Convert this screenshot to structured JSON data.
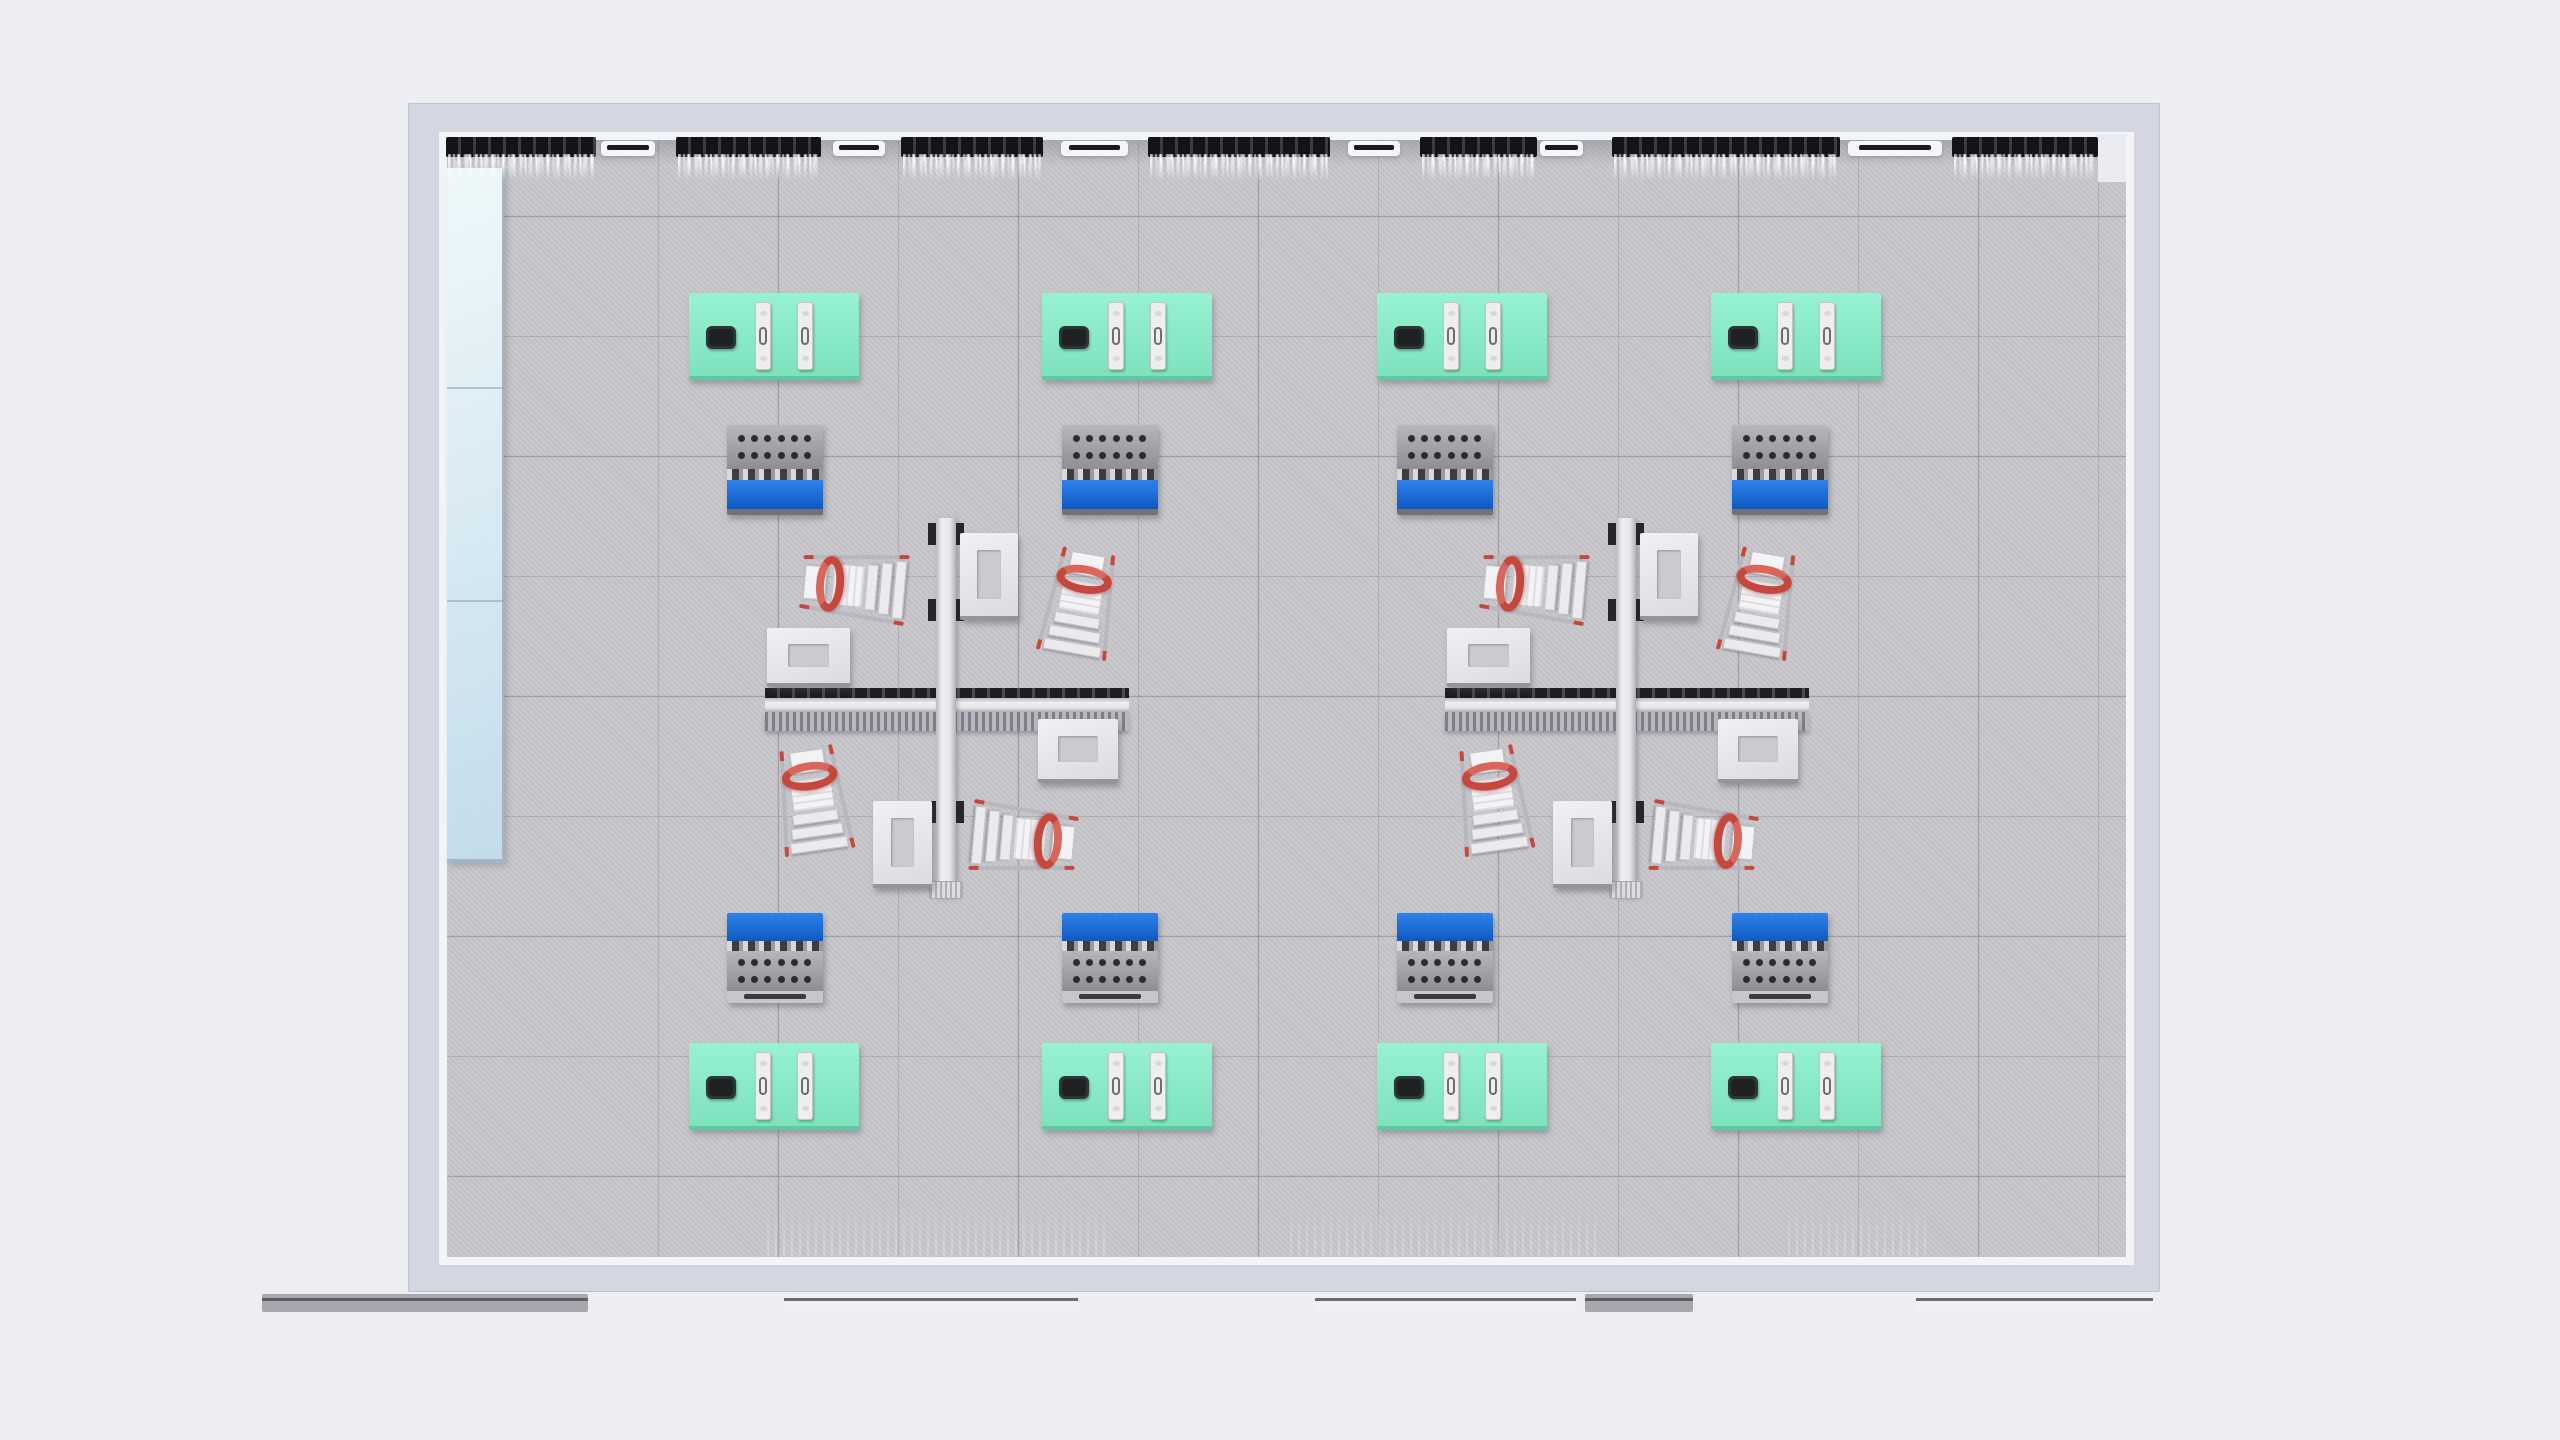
{
  "scene": {
    "description": "Top-down 3D architectural render of a room with four-desk cross workstations, mint tables and tool carts",
    "canvas": {
      "w": 2560,
      "h": 1440,
      "bg": "#edeef3"
    },
    "room": {
      "outer": {
        "x": 408,
        "y": 103,
        "w": 1752,
        "h": 1189
      },
      "wall_color": "#d4d7e2",
      "wall_edge": "#bcc0cf",
      "lip_color": "#f3f4f8",
      "floor": {
        "x": 447,
        "y": 140,
        "w": 1679,
        "h": 1117,
        "color": "#c7c7cb",
        "grid_size": 120,
        "grid_pos_x": 92,
        "grid_pos_y": 39,
        "line_color": "rgba(108,110,120,0.42)"
      }
    },
    "left_panel": {
      "x": 447,
      "y": 168,
      "w": 57,
      "h": 695,
      "seams": [
        387,
        600
      ],
      "top_color": "#eef8fa",
      "bottom_color": "#c3dcea",
      "edge_color": "#9fb6c4",
      "seam_color": "#8fa6b5"
    },
    "curtains": {
      "rail_color": "#141418",
      "rail_y": 137,
      "rail_h": 20,
      "fringe_h": 27,
      "items": [
        [
          446,
          596
        ],
        [
          676,
          821
        ],
        [
          901,
          1043
        ],
        [
          1148,
          1330
        ],
        [
          1420,
          1537
        ],
        [
          1612,
          1840
        ],
        [
          1952,
          2098
        ]
      ]
    },
    "sills": {
      "y": 141,
      "h": 15,
      "body": "#f5f6f9",
      "slot": "#1b1b1f",
      "items": [
        [
          601,
          655
        ],
        [
          833,
          885
        ],
        [
          1061,
          1128
        ],
        [
          1348,
          1400
        ],
        [
          1540,
          1583
        ],
        [
          1848,
          1942
        ]
      ]
    },
    "corner_block": {
      "x": 2098,
      "y": 134,
      "w": 28,
      "h": 48,
      "color": "#e9ebf1"
    },
    "tables": {
      "w": 170,
      "h": 87,
      "fill_top": "#97f2d2",
      "fill_bottom": "#7de2bd",
      "edge": "#5fc9a2",
      "positions": [
        [
          689,
          293
        ],
        [
          1042,
          293
        ],
        [
          1377,
          293
        ],
        [
          1711,
          293
        ],
        [
          689,
          1043
        ],
        [
          1042,
          1043
        ],
        [
          1377,
          1043
        ],
        [
          1711,
          1043
        ]
      ],
      "tablet": {
        "x": 17,
        "y": 33,
        "w": 30,
        "h": 23,
        "color": "#303436",
        "inner": "#1f2224"
      },
      "devices": {
        "xs": [
          66,
          108
        ],
        "y": 9,
        "w": 16,
        "h": 68,
        "body": "#efeeec",
        "border": "#c6c4c0",
        "handle": "#6f6e6c",
        "oval": "#d9d7d3"
      }
    },
    "carts": {
      "w": 96,
      "h": 90,
      "positions_top": [
        [
          727,
          425
        ],
        [
          1062,
          425
        ],
        [
          1397,
          425
        ],
        [
          1732,
          425
        ]
      ],
      "positions_bottom": [
        [
          727,
          913
        ],
        [
          1062,
          913
        ],
        [
          1397,
          913
        ],
        [
          1732,
          913
        ]
      ],
      "blue1": "#2f82ea",
      "blue2": "#0e59c4",
      "gray1": "#b6b6bc",
      "gray2": "#8e8e95",
      "dot_color": "#2b2b30",
      "handle_body": "#c6c6cc",
      "handle_slot": "#3a3a40",
      "base": "#717178"
    },
    "clusters": {
      "centers": [
        [
          946,
          705
        ],
        [
          1626,
          705
        ]
      ],
      "hbar": {
        "x1": -181,
        "x2": 183,
        "strip_top_y1": -17,
        "strip_top_y2": -7,
        "beam_y1": -7,
        "beam_y2": 7,
        "strip_bot_y1": 7,
        "strip_bot_y2": 26
      },
      "vbar": {
        "x1": -10,
        "x2": 10,
        "y1": -187,
        "y2": 192,
        "clamp_ys": [
          -182,
          -106,
          96
        ],
        "clamp_w": 8,
        "clamp_h": 22,
        "foot_w": 34,
        "foot_h": 18
      },
      "beam_strip_dark": "#1e1e23",
      "desks": [
        {
          "x": 14,
          "y": -172,
          "w": 58,
          "h": 87
        },
        {
          "x": -179,
          "y": -77,
          "w": 83,
          "h": 59
        },
        {
          "x": 92,
          "y": 14,
          "w": 80,
          "h": 64
        },
        {
          "x": -73,
          "y": 96,
          "w": 59,
          "h": 87
        }
      ],
      "desk_fill1": "#f1f0f3",
      "desk_fill2": "#dcdbdf",
      "desk_panel": "#cacad0",
      "desk_edge": "#95949b",
      "chair": {
        "w": 78,
        "h": 112,
        "red": "#c7473d",
        "red_hi": "#d9655b",
        "frame": "#b7b8be",
        "seat": "#f3f2f4",
        "step": "#ebeaed",
        "step_edge": "#c2c2c6"
      },
      "chairs": [
        {
          "cx": -92,
          "cy": -119,
          "rot": -85
        },
        {
          "cx": 134,
          "cy": -102,
          "rot": 10
        },
        {
          "cx": -133,
          "cy": 95,
          "rot": -8
        },
        {
          "cx": 78,
          "cy": 134,
          "rot": 95
        }
      ]
    },
    "bottom_fringes": {
      "y": 1206,
      "h": 50,
      "items": [
        [
          767,
          1110
        ],
        [
          1290,
          1600
        ],
        [
          1788,
          1927
        ]
      ]
    },
    "bottom_bars": {
      "y": 1294,
      "h": 18,
      "light": "#eff0f4",
      "dark": "#a7a8ae",
      "line": "#4a4a52",
      "items": [
        {
          "x1": 262,
          "x2": 588,
          "tone": "dark"
        },
        {
          "x1": 784,
          "x2": 1078,
          "tone": "light"
        },
        {
          "x1": 1315,
          "x2": 1576,
          "tone": "light"
        },
        {
          "x1": 1585,
          "x2": 1693,
          "tone": "dark"
        },
        {
          "x1": 1916,
          "x2": 2153,
          "tone": "light"
        }
      ]
    }
  }
}
